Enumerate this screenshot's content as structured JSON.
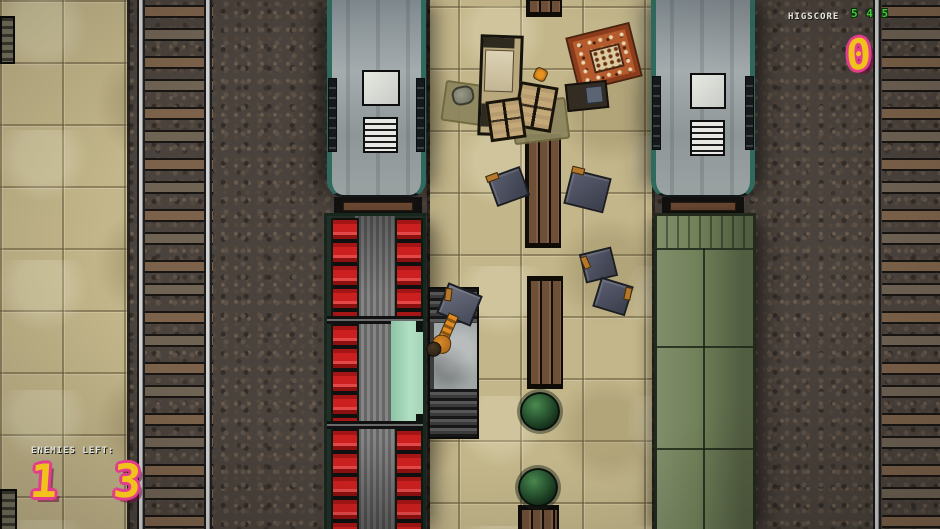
{
  "hud": {
    "highscore_label": "HIGSCORE",
    "score_top": "5 4 5",
    "score_value": "0",
    "enemies_label": "ENEMIES LEFT:",
    "enemies_value": "1 3"
  },
  "colors": {
    "hud_number_fill": "#f2c21c",
    "hud_number_outline": "#e23c8c",
    "hud_score_green": "#44c83c",
    "hud_text_white": "#e4e4dc",
    "train_seat_red": "#c32020",
    "train_body_green": "#72825a",
    "train_body_silver": "#9aa2a4",
    "platform_tan": "#c3b68a",
    "barrel_green": "#2c5c34",
    "open_floor_teal": "#a4d4b8"
  }
}
